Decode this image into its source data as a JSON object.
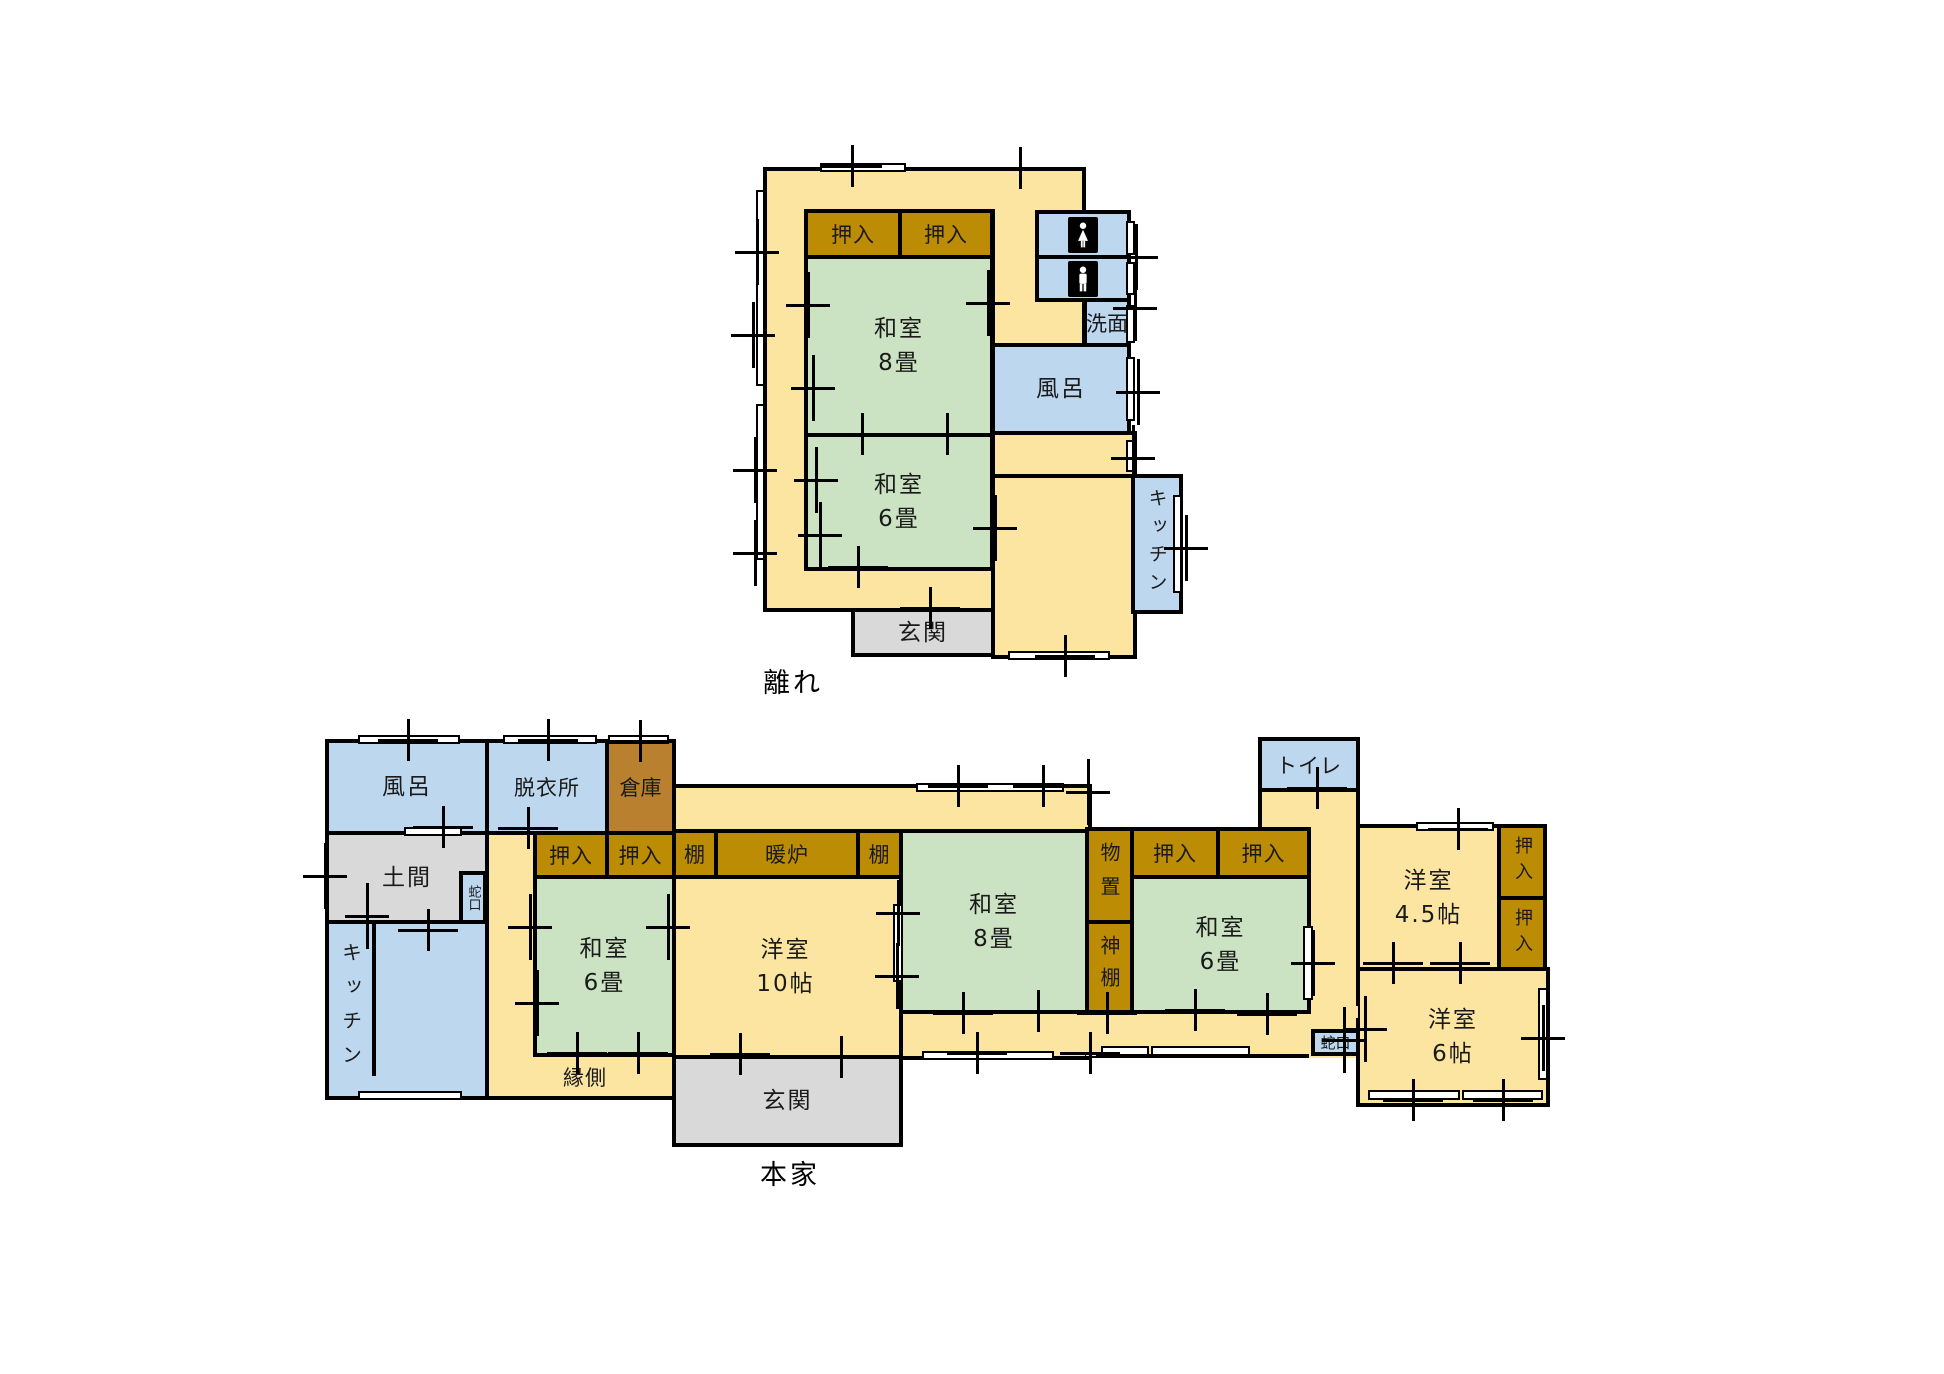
{
  "colors": {
    "paper": "#FFFFFF",
    "yellow": "#FBE5A0",
    "green": "#CBE3C2",
    "blue": "#BDD7EE",
    "closet": "#BC8D04",
    "storage": "#B9812F",
    "gray": "#D9D9D9",
    "wall": "#000000",
    "window": "#FFFFFF"
  },
  "icons": {
    "toilet_female": "female-figure",
    "toilet_male": "male-figure"
  },
  "hanare": {
    "caption": "離れ",
    "rooms": {
      "oshiire_1": "押入",
      "oshiire_2": "押入",
      "washitsu8": {
        "name": "和室",
        "size": "8畳"
      },
      "washitsu6": {
        "name": "和室",
        "size": "6畳"
      },
      "senmen": "洗面",
      "furo": "風呂",
      "kitchen": "キッチン",
      "genkan": "玄関"
    }
  },
  "honke": {
    "caption": "本家",
    "rooms": {
      "furo": "風呂",
      "datsuijo": "脱衣所",
      "souko": "倉庫",
      "doma": "土間",
      "jaguchi_doma": "蛇口",
      "kitchen": "キッチン",
      "oshiire_w1": "押入",
      "oshiire_w2": "押入",
      "tana_1": "棚",
      "danro": "暖炉",
      "tana_2": "棚",
      "washitsu6_west": {
        "name": "和室",
        "size": "6畳"
      },
      "yoshitsu10": {
        "name": "洋室",
        "size": "10帖"
      },
      "washitsu8": {
        "name": "和室",
        "size": "8畳"
      },
      "monooki": "物置",
      "kamidana": "神棚",
      "oshiire_e1": "押入",
      "oshiire_e2": "押入",
      "washitsu6_east": {
        "name": "和室",
        "size": "6畳"
      },
      "toilet": "トイレ",
      "yoshitsu45": {
        "name": "洋室",
        "size": "4.5帖"
      },
      "oshiire_v1": "押入",
      "oshiire_v2": "押入",
      "yoshitsu6": {
        "name": "洋室",
        "size": "6帖"
      },
      "jaguchi_2": "蛇口",
      "engawa": "縁側",
      "genkan": "玄関"
    }
  }
}
